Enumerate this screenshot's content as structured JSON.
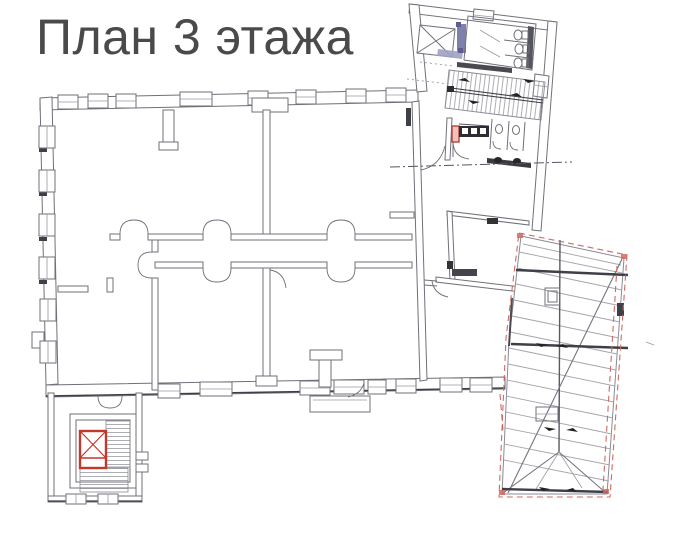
{
  "title": "План 3 этажа",
  "colors": {
    "background": "#ffffff",
    "title_text": "#4a4a4a",
    "wall": "#70707a",
    "wall_light": "#9a9aa4",
    "wall_dark": "#3f3f48",
    "roof_line": "#a5a5ad",
    "red": "#c0392b",
    "red_dash": "#d06a62",
    "blue": "#8080ac",
    "blue_dark": "#5d5d92",
    "fixture_black": "#2d2d33"
  },
  "plan": {
    "areas": [
      {
        "name": "main-building",
        "kind": "walls-with-windows"
      },
      {
        "name": "central-corridor",
        "kind": "double-loaded-corridor"
      },
      {
        "name": "north-wing",
        "kind": "stair-and-sanitary-block"
      },
      {
        "name": "north-elevator-shaft",
        "kind": "shaft-cross"
      },
      {
        "name": "north-staircase",
        "kind": "stairs"
      },
      {
        "name": "toilet-room",
        "kind": "three-toilets"
      },
      {
        "name": "washbasin-counter",
        "kind": "black-counter-three-sinks"
      },
      {
        "name": "west-stair-tower",
        "kind": "stairs"
      },
      {
        "name": "west-elevator-shaft",
        "kind": "red-highlighted-shaft"
      },
      {
        "name": "balcony",
        "kind": "south-balcony"
      },
      {
        "name": "roof-wing",
        "kind": "hip-roof-plan-red-dashed"
      }
    ]
  }
}
